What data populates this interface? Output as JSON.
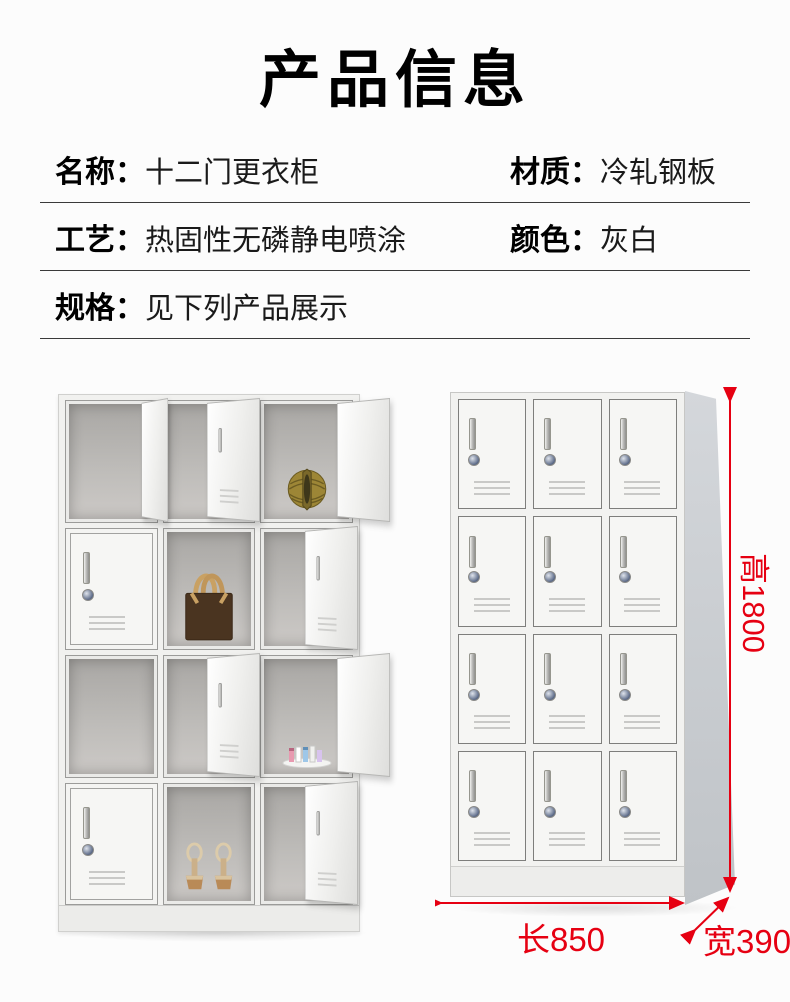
{
  "page": {
    "background": "#fcfcfc",
    "accent_red": "#e60012",
    "cabinet_color_hex": "#f2f2f0"
  },
  "header": {
    "title": "产品信息"
  },
  "specs": {
    "rows": [
      {
        "left_label": "名称：",
        "left_value": "十二门更衣柜",
        "right_label": "材质：",
        "right_value": "冷轧钢板"
      },
      {
        "left_label": "工艺：",
        "left_value": "热固性无磷静电喷涂",
        "right_label": "颜色：",
        "right_value": "灰白"
      },
      {
        "left_label": "规格：",
        "left_value": "见下列产品展示",
        "right_label": "",
        "right_value": ""
      }
    ]
  },
  "display": {
    "left_locker": {
      "items": [
        "gold-ornament-icon",
        "handbag-icon",
        "cosmetics-icon",
        "sandals-icon"
      ]
    },
    "dimensions": {
      "height": "高1800",
      "length": "长850",
      "width": "宽390"
    }
  }
}
